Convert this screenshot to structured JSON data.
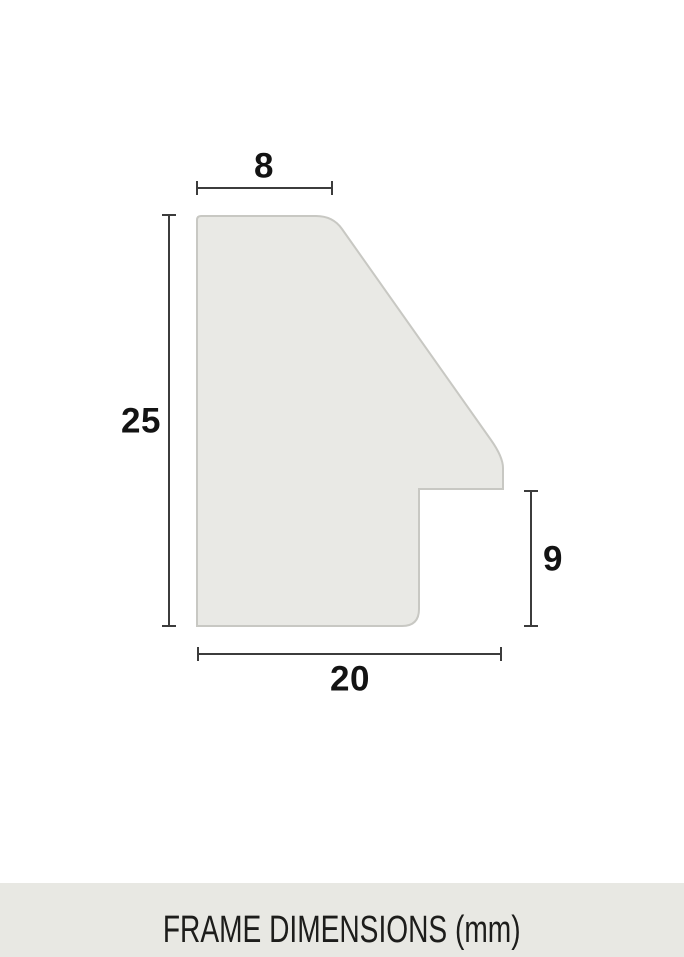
{
  "diagram": {
    "title": "frame-profile-cross-section",
    "unit": "mm",
    "dimensions": {
      "top_width": "8",
      "left_height": "25",
      "right_height": "9",
      "bottom_width": "20"
    },
    "colors": {
      "background": "#ffffff",
      "shape_fill": "#e9e9e5",
      "shape_border": "#c8c8c3",
      "dimension_line": "#3c3c3c",
      "label_text": "#131313"
    }
  },
  "footer": {
    "label": "FRAME DIMENSIONS (mm)",
    "background": "#e8e8e3",
    "text_color": "#1d1d1b"
  }
}
